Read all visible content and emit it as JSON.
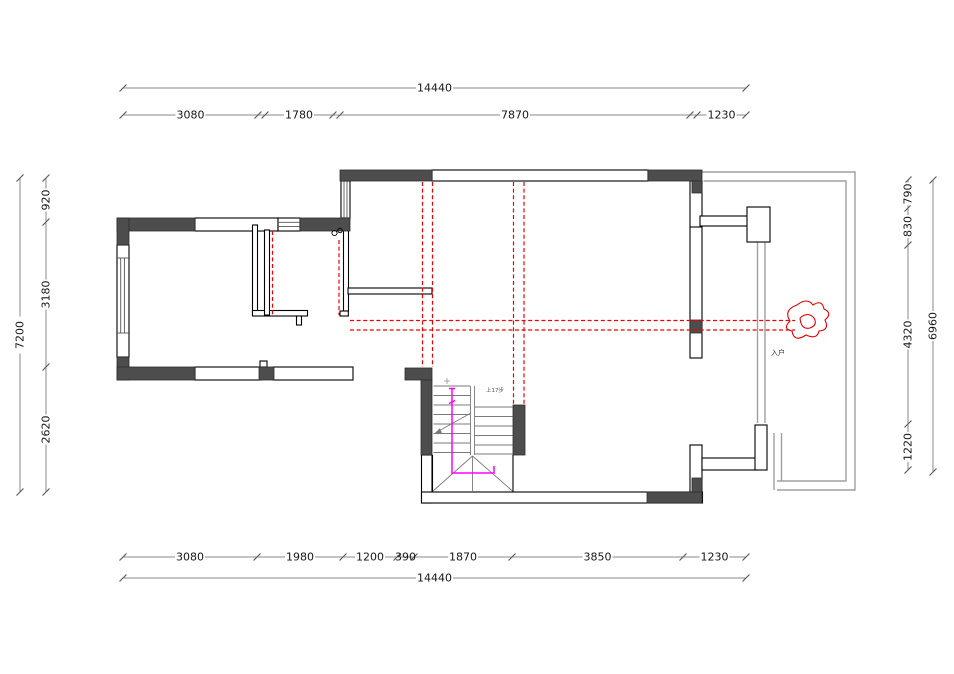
{
  "drawing": {
    "type": "floor-plan-cad",
    "dims": {
      "top": {
        "total": "14440",
        "segments": [
          "3080",
          "1780",
          "7870",
          "1230"
        ]
      },
      "bottom": {
        "total": "14440",
        "segments": [
          "3080",
          "1980",
          "1200",
          "390",
          "1870",
          "3850",
          "1230"
        ]
      },
      "left": {
        "total": "7200",
        "segments": [
          "920",
          "3180",
          "2620"
        ]
      },
      "right": {
        "total": "6960",
        "segments": [
          "790",
          "830",
          "4320",
          "1220"
        ]
      }
    },
    "annotations": {
      "stair_note": "上17步",
      "entry_label": "入户"
    },
    "colors": {
      "wall_fill": "#4d4d4d",
      "demolition_red": "#f00000",
      "route_magenta": "#ff00ff",
      "boundary_gray": "#a0a0a0",
      "dim_text": "#161616"
    }
  }
}
